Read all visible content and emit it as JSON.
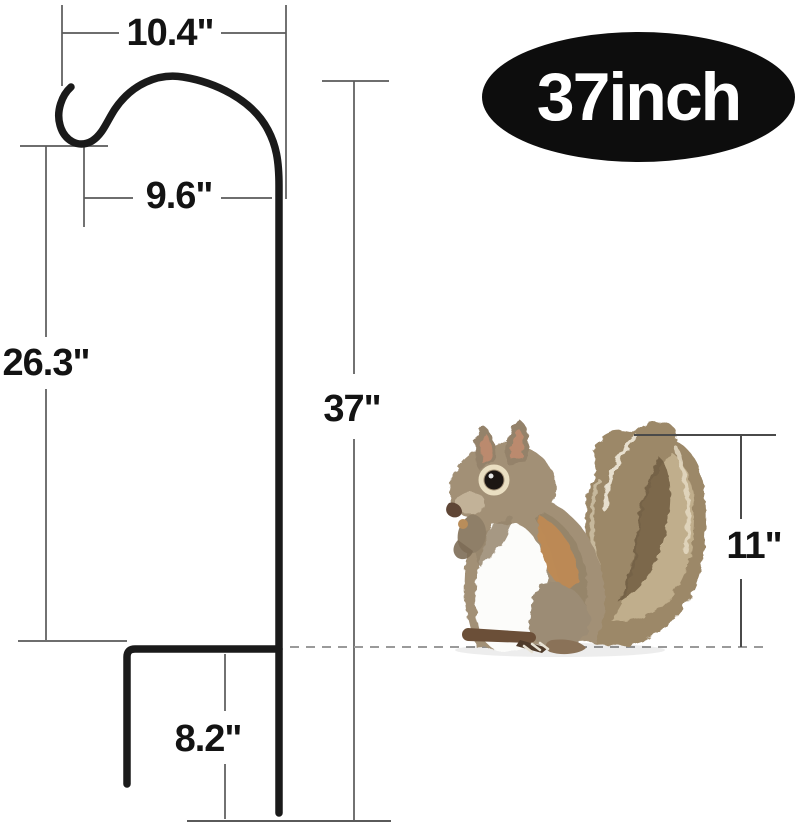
{
  "badge": {
    "label": "37inch",
    "bg_color": "#0d0d0d",
    "text_color": "#ffffff"
  },
  "dimensions": {
    "hook_width": {
      "label": "10.4\""
    },
    "hook_opening_height": {
      "label": "9.6\""
    },
    "pole_upper_height": {
      "label": "26.3\""
    },
    "total_height": {
      "label": "37\""
    },
    "squirrel_height": {
      "label": "11\""
    },
    "ground_stake_depth": {
      "label": "8.2\""
    }
  },
  "colors": {
    "pole": "#1a1a1a",
    "dimension_lines": "#5a5a5a",
    "dashed_ground_line": "#9a9a9a",
    "label_text": "#131313",
    "background": "#ffffff"
  }
}
